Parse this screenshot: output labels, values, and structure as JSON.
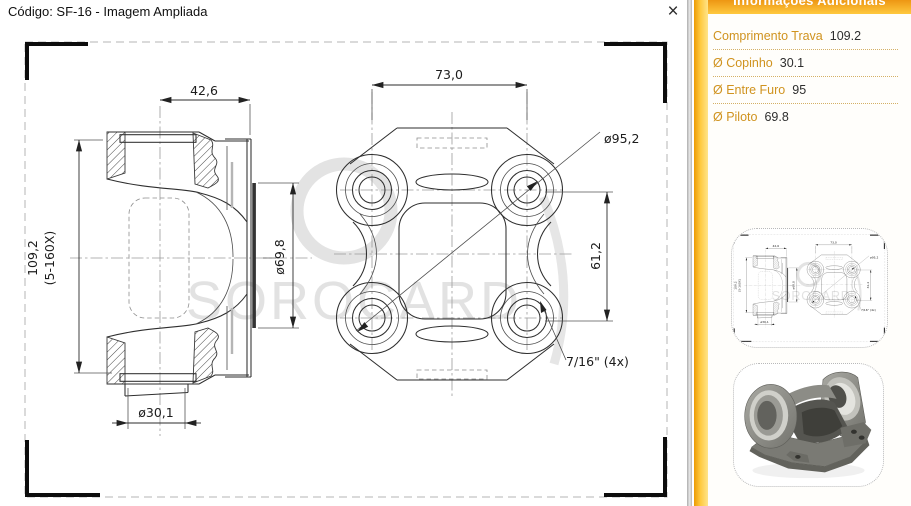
{
  "dialog": {
    "title": "Código: SF-16 - Imagem Ampliada",
    "close_glyph": "×"
  },
  "drawing": {
    "watermark": "SOROCARD",
    "dims": {
      "yoke_width": "42,6",
      "flange_width": "73,0",
      "bolt_circle": "ø95,2",
      "overall_length": "109,2",
      "length_note": "(5-160X)",
      "pilot_dia": "ø69,8",
      "hole_spacing": "61,2",
      "thread": "7/16\" (4x)",
      "bore_dia": "ø30,1"
    }
  },
  "sidebar": {
    "header": "Informações Adicionais",
    "items": [
      {
        "label": "Comprimento Trava",
        "value": "109.2"
      },
      {
        "label": "Ø Copinho",
        "value": "30.1"
      },
      {
        "label": "Ø Entre Furo",
        "value": "95"
      },
      {
        "label": "Ø Piloto",
        "value": "69.8"
      }
    ],
    "thumbnails": [
      {
        "name": "technical-drawing-thumbnail"
      },
      {
        "name": "part-photo-thumbnail"
      }
    ]
  },
  "colors": {
    "accent_orange": "#ee9613",
    "accent_yellow": "#ffc93e",
    "label_gold": "#d0931f",
    "value_dark": "#2e2e2e",
    "watermark_gray": "#e2e2e2"
  }
}
